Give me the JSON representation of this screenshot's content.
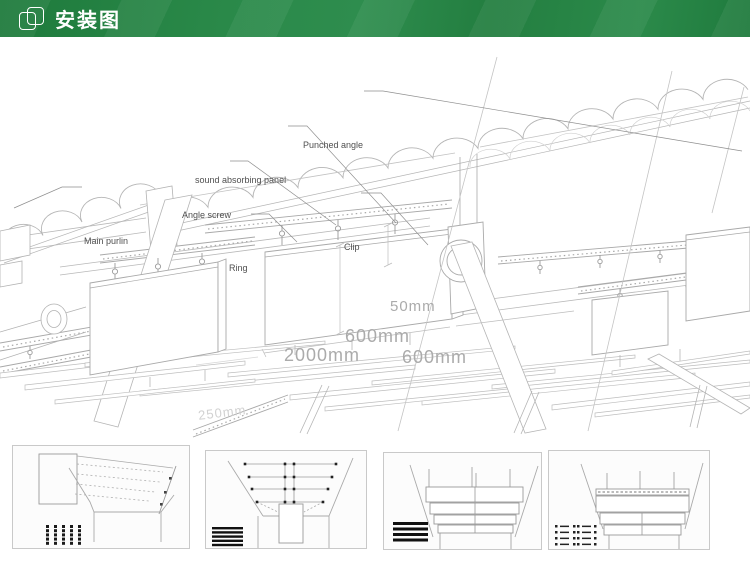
{
  "header": {
    "title": "安装图"
  },
  "diagram": {
    "labels": {
      "main_purlin": "Main purlin",
      "angle_screw": "Angle screw",
      "sound_absorbing_panel": "sound absorbing panel",
      "punched_angle": "Punched angle",
      "clip": "Clip",
      "ring": "Ring"
    },
    "dimensions": {
      "panel_thickness": "50mm",
      "panel_height": "600mm",
      "panel_length": "2000mm",
      "panel_spacing": "600mm",
      "hanger_spacing": "250mm"
    }
  }
}
